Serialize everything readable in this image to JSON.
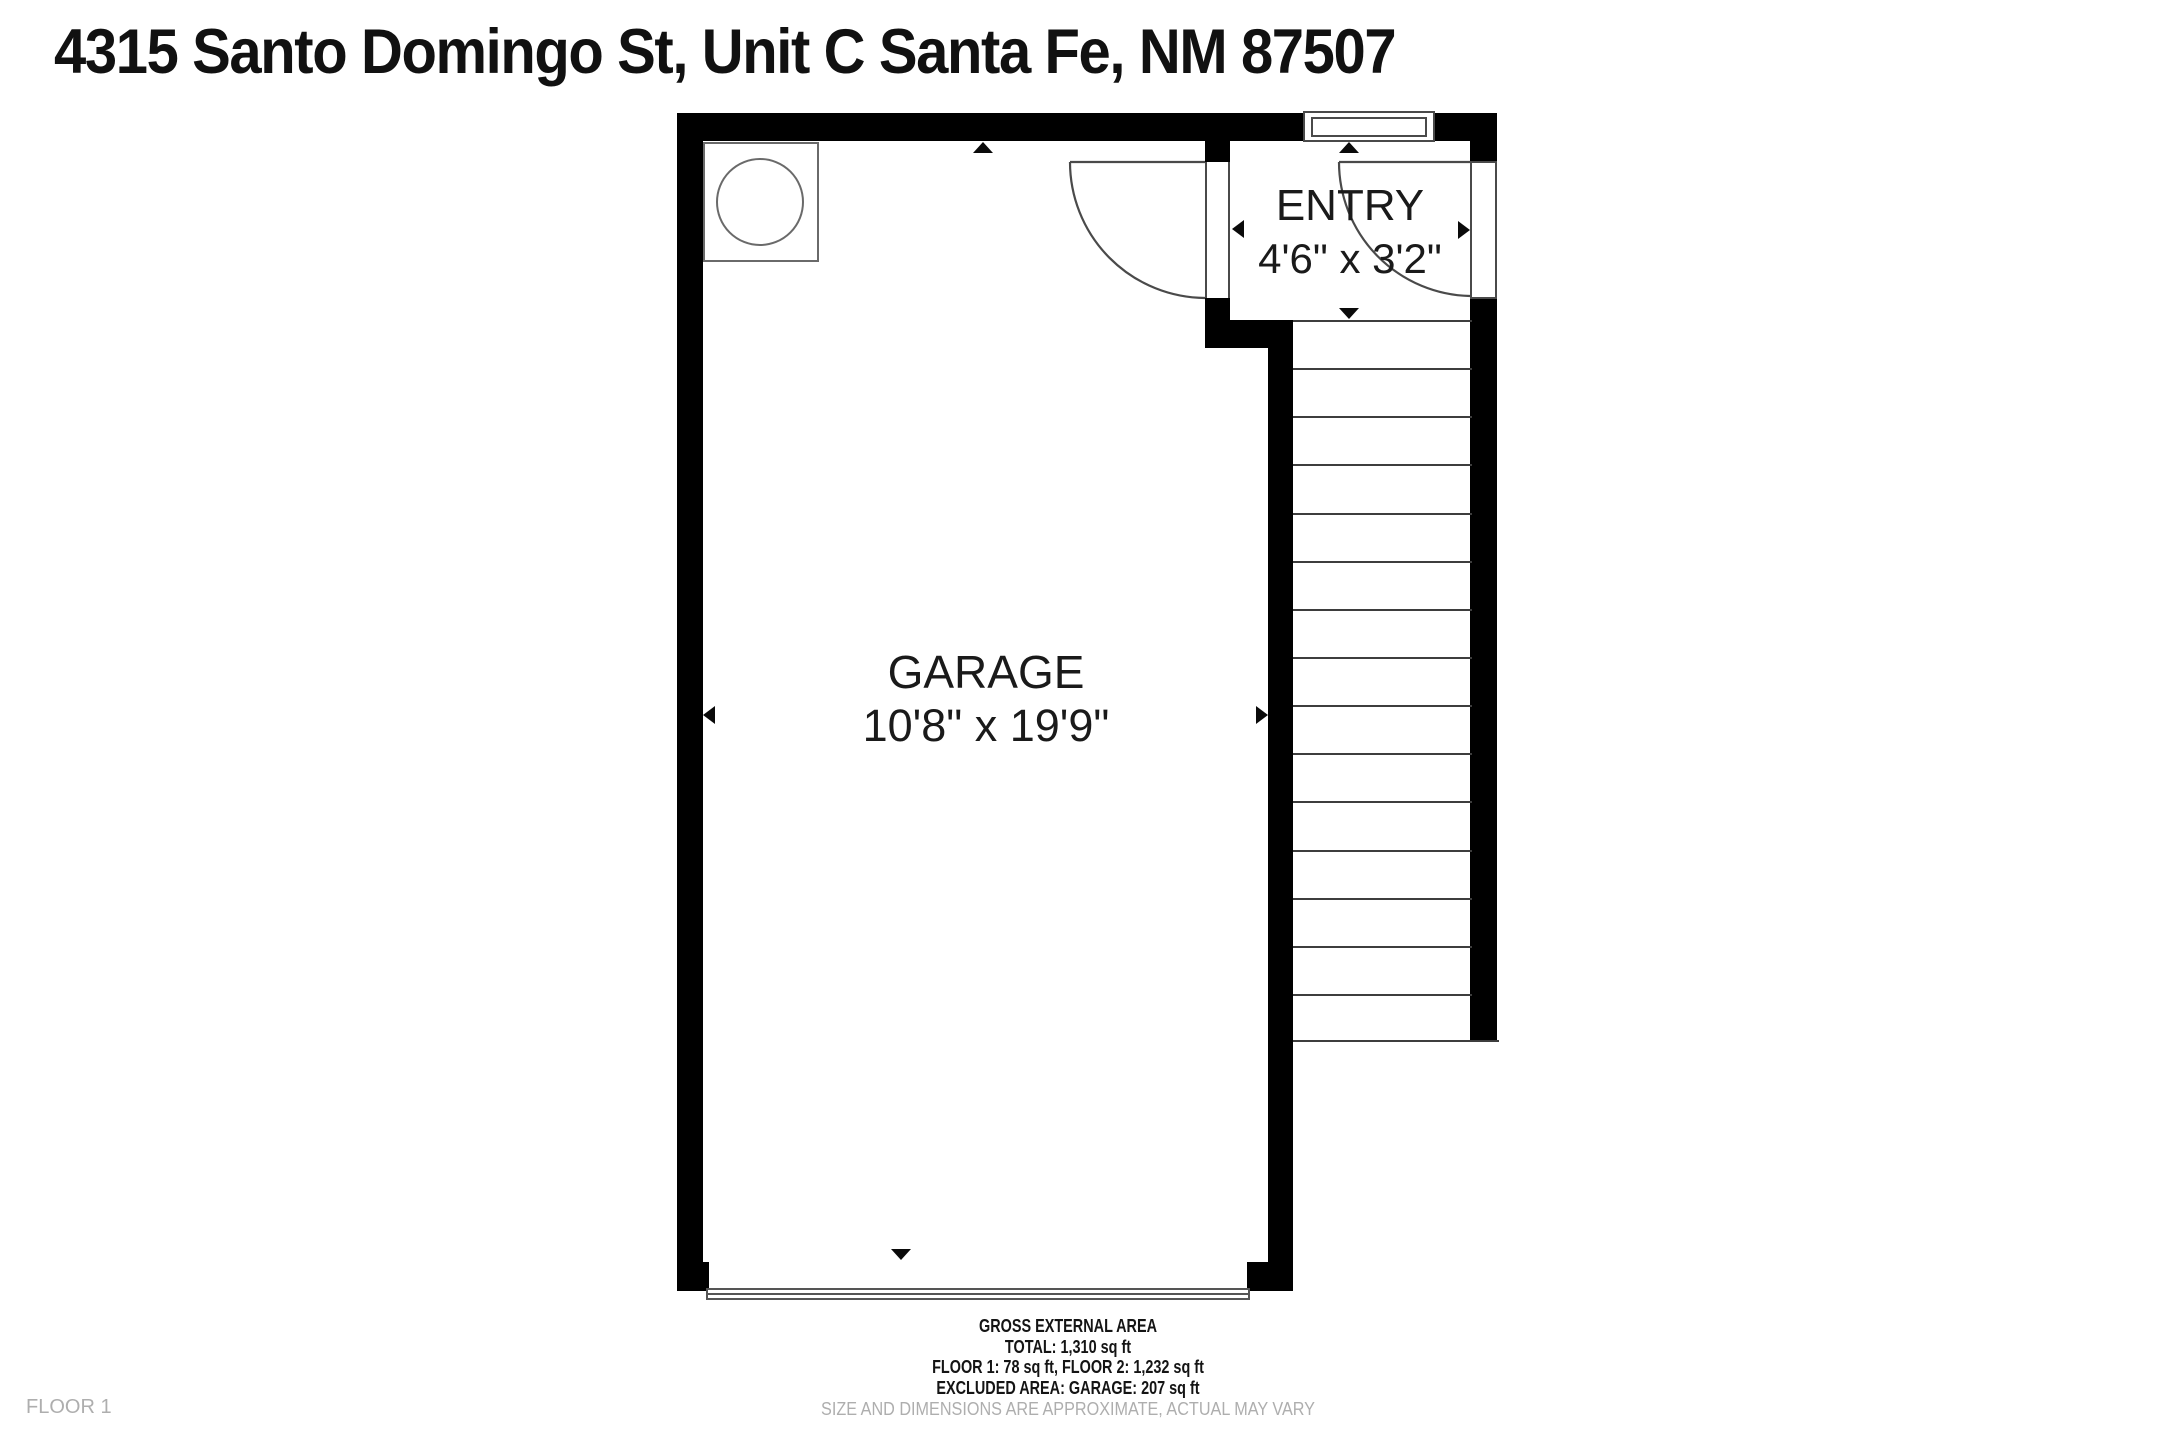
{
  "page": {
    "title": "4315 Santo Domingo St, Unit C Santa Fe, NM 87507",
    "floor_label": "FLOOR 1"
  },
  "rooms": {
    "garage": {
      "name": "GARAGE",
      "dimensions": "10'8\" x 19'9\""
    },
    "entry": {
      "name": "ENTRY",
      "dimensions": "4'6\" x 3'2\""
    }
  },
  "stairs": {
    "tread_count": 15
  },
  "footer": {
    "area_heading": "GROSS EXTERNAL AREA",
    "total": "TOTAL: 1,310 sq ft",
    "floors": "FLOOR 1: 78 sq ft, FLOOR 2: 1,232 sq ft",
    "excluded": "EXCLUDED AREA: GARAGE: 207 sq ft",
    "disclaimer": "SIZE AND DIMENSIONS ARE APPROXIMATE, ACTUAL MAY VARY"
  },
  "colors": {
    "wall": "#000000",
    "line": "#4a4a4a",
    "text": "#1a1a1a",
    "muted": "#aeaeae"
  }
}
